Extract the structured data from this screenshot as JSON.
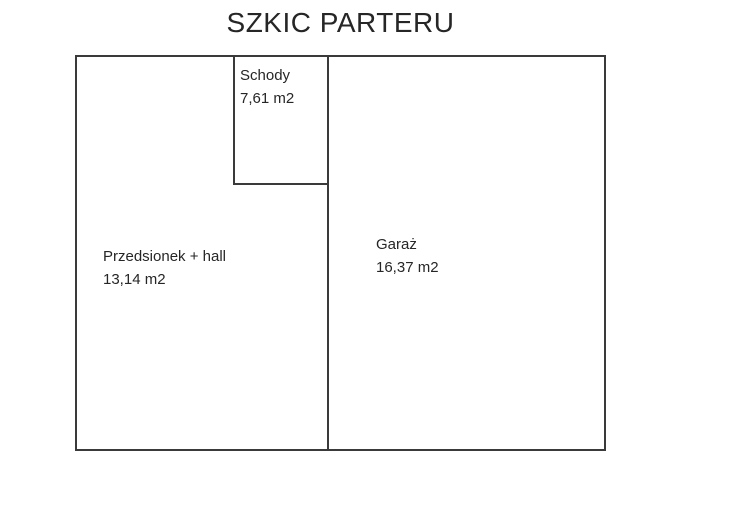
{
  "title": "SZKIC PARTERU",
  "rooms": [
    {
      "name": "Schody",
      "area": "7,61 m2"
    },
    {
      "name": "Przedsionek + hall",
      "area": "13,14 m2"
    },
    {
      "name": "Garaż",
      "area": "16,37 m2"
    }
  ],
  "colors": {
    "wall": "#3a3a3a",
    "text": "#262626",
    "background": "#ffffff"
  }
}
